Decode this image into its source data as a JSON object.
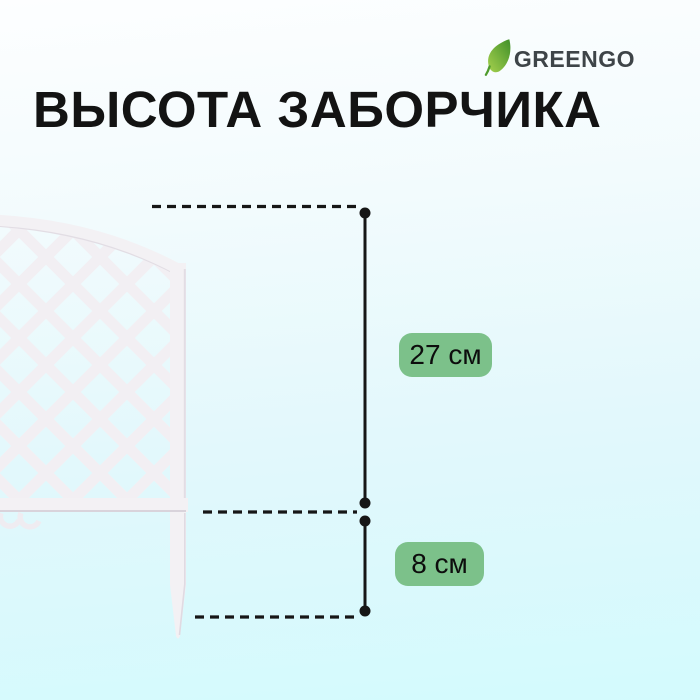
{
  "brand": {
    "name": "GREENGO",
    "icon": "leaf-icon"
  },
  "title": "ВЫСОТА ЗАБОРЧИКА",
  "dimensions": [
    {
      "label": "27 см",
      "value": 27,
      "unit": "см",
      "part": "panel-above-ground"
    },
    {
      "label": "8 см",
      "value": 8,
      "unit": "см",
      "part": "ground-stake"
    }
  ],
  "product": {
    "name": "заборчик",
    "appearance": "white plastic lattice fence section with arched top and ground stake"
  },
  "colors": {
    "badge_green": "#7cc18a",
    "dimension_line": "#161616",
    "fence_white": "#f3f1f4",
    "background_top": "#fdfeff",
    "background_bottom": "#d3fafd",
    "title_color": "#131313",
    "brand_text": "#3e4448",
    "leaf_green_dark": "#4f9b2d",
    "leaf_green_light": "#a6d14e"
  }
}
